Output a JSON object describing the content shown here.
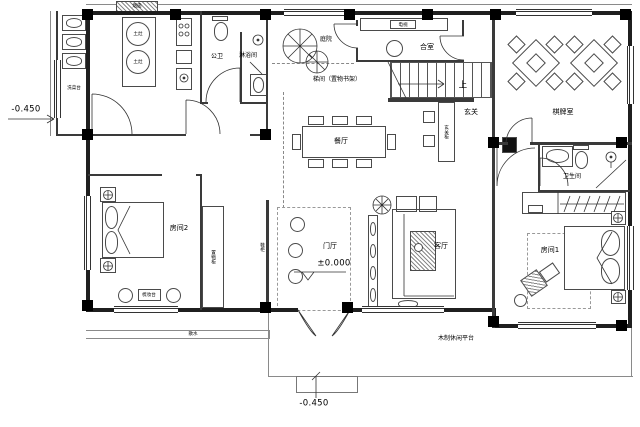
{
  "labels": {
    "flue": "烟囱",
    "stove1": "土灶",
    "stove2": "土灶",
    "wash_counter": "洗菜台",
    "public_wc": "公卫",
    "shower_room": "淋浴间",
    "courtyard": "庭院",
    "tv_unit": "电视",
    "tatami_room": "合室",
    "stair_room": "梯间（置物书架）",
    "stair_up": "上",
    "chess_room": "棋牌室",
    "entry_hall": "玄关",
    "entry_cabinet": "玄关柜",
    "dining_room": "餐厅",
    "bedroom2": "房间2",
    "storage_cabinet": "置物柜",
    "dresser": "梳妆台",
    "shoe_cabinet": "鞋柜",
    "foyer": "门厅",
    "living_room": "客厅",
    "bathroom": "卫生间",
    "bedroom1": "房间1",
    "wood_platform": "木制休闲平台",
    "apron": "散水"
  },
  "levels": {
    "foyer_level": "±0.000",
    "site_level_left": "-0.450",
    "site_level_bottom": "-0.450"
  },
  "colors": {
    "line": "#1f1f1f",
    "background": "#ffffff"
  }
}
